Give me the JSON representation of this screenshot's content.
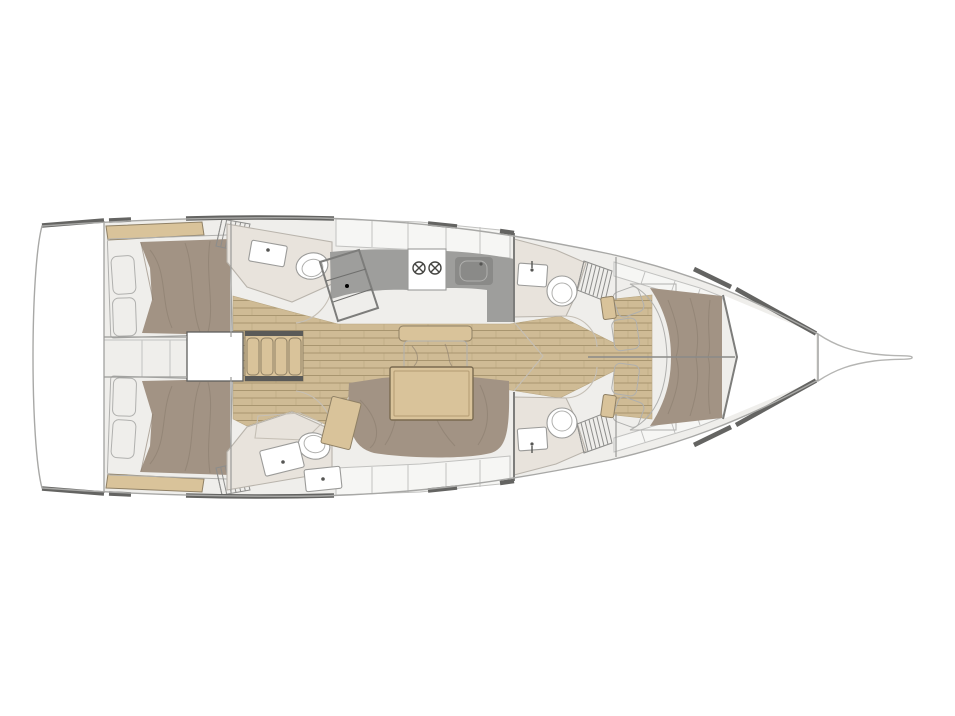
{
  "meta": {
    "title": "Sailing yacht interior layout — top-down floor plan, bow to the right",
    "canvas": {
      "width": 955,
      "height": 716
    }
  },
  "colors": {
    "white": "#ffffff",
    "hull_outline": "#a8a8a6",
    "sprit_outline": "#b5b5b3",
    "deck_edge": "#646462",
    "interior": "#efeeeb",
    "locker_panel": "#f6f6f4",
    "room_floor": "#e8e3dc",
    "shower_floor": "#efeae4",
    "teak": "#cfbb95",
    "teak_line": "#a8956f",
    "counter": "#9e9e9c",
    "chart_table": "#8b8b89",
    "appliance": "#8a8a88",
    "bed": "#a29384",
    "mattress": "#ebe1d3",
    "pillow": "#f5f4f2",
    "wood_tan": "#d9c39a",
    "wall_dark": "#5a5a58"
  },
  "elements": [
    {
      "name": "hull",
      "kind": "boat hull outline, bow pointing right"
    },
    {
      "name": "bow-sprit",
      "kind": "bowsprit / stem fitting at bow tip"
    },
    {
      "name": "anchor-locker",
      "kind": "forepeak anchor locker"
    },
    {
      "name": "forward-cabin",
      "kind": "V-berth double bed with 4 pillows"
    },
    {
      "name": "forward-head-top",
      "kind": "bathroom with toilet and sink"
    },
    {
      "name": "forward-head-bottom",
      "kind": "bathroom with toilet and sink"
    },
    {
      "name": "galley",
      "kind": "counter with two-burner stove and sink"
    },
    {
      "name": "chart-table",
      "kind": "navigation table"
    },
    {
      "name": "salon",
      "kind": "U-shaped settee, dining table, bench seat, teak sole"
    },
    {
      "name": "companionway",
      "kind": "entry steps with four treads"
    },
    {
      "name": "aft-cabin-top",
      "kind": "double berth with two pillows"
    },
    {
      "name": "aft-cabin-bottom",
      "kind": "double berth with two pillows"
    },
    {
      "name": "aft-head-top",
      "kind": "bathroom with toilet and sink"
    },
    {
      "name": "aft-head-bottom",
      "kind": "bathroom with shower, toilet, sink and cabinet"
    },
    {
      "name": "transom",
      "kind": "stern platform area"
    }
  ]
}
